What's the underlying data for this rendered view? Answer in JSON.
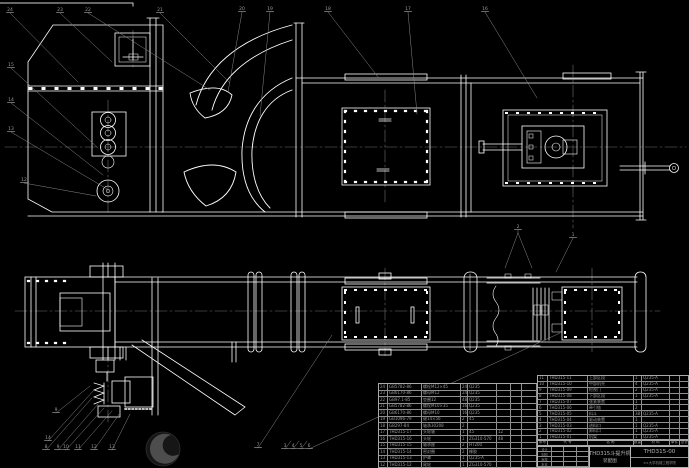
{
  "colors": {
    "background": "#000000",
    "line": "#ffffff",
    "leader": "#8a8a8a",
    "centerline": "#6f6f6f",
    "table_line": "#9b9b9b",
    "table_text": "#9a9a9a"
  },
  "title_block": {
    "product_name": "THD315斗提升机",
    "sheet_name": "装配图",
    "drawing_no": "THD315-00",
    "org": "××大学机械工程学院",
    "sig_labels": [
      "设计",
      "制图",
      "审核",
      "批准"
    ]
  },
  "bom": {
    "header": [
      "序号",
      "代  号",
      "名  称",
      "数量",
      "材  料",
      "单件",
      "总计",
      "备注"
    ],
    "right_rows": [
      [
        "11",
        "THD315-11",
        "上部区段",
        "1",
        "Q235-A",
        "",
        "",
        ""
      ],
      [
        "10",
        "THD315-10",
        "中部机壳",
        "4",
        "Q235-A",
        "",
        "",
        ""
      ],
      [
        "9",
        "THD315-09",
        "检视门",
        "2",
        "Q235-A",
        "",
        "",
        ""
      ],
      [
        "8",
        "THD315-08",
        "下部区段",
        "1",
        "Q235-A",
        "",
        "",
        ""
      ],
      [
        "7",
        "THD315-07",
        "张紧装置",
        "1",
        "",
        "",
        "",
        "螺旋式"
      ],
      [
        "6",
        "THD315-06",
        "牵引链",
        "2",
        "",
        "",
        "",
        ""
      ],
      [
        "5",
        "THD315-05",
        "料斗",
        "38",
        "Q235-A",
        "",
        "",
        ""
      ],
      [
        "4",
        "THD315-04",
        "驱动装置",
        "1",
        "",
        "",
        "",
        "Y132M-4"
      ],
      [
        "3",
        "THD315-03",
        "进料口",
        "1",
        "Q235-A",
        "",
        "",
        ""
      ],
      [
        "2",
        "THD315-02",
        "卸料口",
        "1",
        "Q235-A",
        "",
        "",
        ""
      ],
      [
        "1",
        "THD315-01",
        "机架",
        "1",
        "Q235-A",
        "",
        "",
        ""
      ]
    ],
    "left_rows": [
      [
        "24",
        "GB5782-86",
        "螺栓M12×45",
        "24",
        "Q235",
        "",
        "",
        ""
      ],
      [
        "23",
        "GB6170-86",
        "螺母M12",
        "24",
        "Q235",
        "",
        "",
        ""
      ],
      [
        "22",
        "GB97.1-85",
        "垫圈12",
        "48",
        "Q235",
        "",
        "",
        ""
      ],
      [
        "21",
        "GB5782-86",
        "螺栓M10×35",
        "16",
        "Q235",
        "",
        "",
        ""
      ],
      [
        "20",
        "GB6170-86",
        "螺母M10",
        "16",
        "Q235",
        "",
        "",
        ""
      ],
      [
        "19",
        "GB1096-79",
        "键14×56",
        "2",
        "45",
        "",
        "",
        ""
      ],
      [
        "18",
        "GB297-84",
        "轴承30208",
        "2",
        "",
        "",
        "",
        ""
      ],
      [
        "17",
        "THD315-17",
        "头轮轴",
        "1",
        "45",
        "12",
        "",
        ""
      ],
      [
        "16",
        "THD315-16",
        "头轮",
        "1",
        "ZG310-570",
        "48",
        "",
        ""
      ],
      [
        "15",
        "THD315-15",
        "轴承座",
        "2",
        "HT200",
        "",
        "",
        ""
      ],
      [
        "14",
        "THD315-14",
        "密封圈",
        "2",
        "橡胶",
        "",
        "",
        ""
      ],
      [
        "13",
        "THD315-13",
        "护罩",
        "1",
        "Q235-A",
        "",
        "",
        ""
      ],
      [
        "12",
        "THD315-12",
        "尾轮",
        "1",
        "ZG310-570",
        "",
        "",
        ""
      ]
    ]
  },
  "balloons": [
    {
      "label": "24",
      "x": 10,
      "y": 11,
      "lx": 78,
      "ly": 82
    },
    {
      "label": "23",
      "x": 60,
      "y": 11,
      "lx": 112,
      "ly": 62
    },
    {
      "label": "22",
      "x": 88,
      "y": 11,
      "lx": 210,
      "ly": 90
    },
    {
      "label": "21",
      "x": 160,
      "y": 11,
      "lx": 230,
      "ly": 83
    },
    {
      "label": "20",
      "x": 242,
      "y": 10,
      "lx": 228,
      "ly": 92
    },
    {
      "label": "19",
      "x": 270,
      "y": 10,
      "lx": 260,
      "ly": 116
    },
    {
      "label": "18",
      "x": 328,
      "y": 10,
      "lx": 378,
      "ly": 77
    },
    {
      "label": "17",
      "x": 408,
      "y": 10,
      "lx": 417,
      "ly": 114
    },
    {
      "label": "16",
      "x": 485,
      "y": 10,
      "lx": 537,
      "ly": 98
    },
    {
      "label": "15",
      "x": 11,
      "y": 66,
      "lx": 98,
      "ly": 148
    },
    {
      "label": "14",
      "x": 11,
      "y": 101,
      "lx": 103,
      "ly": 175
    },
    {
      "label": "13",
      "x": 11,
      "y": 130,
      "lx": 107,
      "ly": 189
    },
    {
      "label": "12",
      "x": 24,
      "y": 181,
      "lx": 96,
      "ly": 196
    },
    {
      "label": "1",
      "x": 573,
      "y": 236,
      "lx": 556,
      "ly": 272
    },
    {
      "label": "2",
      "x": 518,
      "y": 228,
      "lx": 518,
      "ly": 233
    },
    {
      "label": "3",
      "x": 285,
      "y": 447,
      "lx": 291,
      "ly": 441
    },
    {
      "label": "4",
      "x": 293,
      "y": 447,
      "lx": 299,
      "ly": 441
    },
    {
      "label": "5",
      "x": 301,
      "y": 447,
      "lx": 307,
      "ly": 441
    },
    {
      "label": "6",
      "x": 309,
      "y": 447,
      "lx": 560,
      "ly": 333
    },
    {
      "label": "7",
      "x": 258,
      "y": 446,
      "lx": 332,
      "ly": 335
    },
    {
      "label": "8",
      "x": 46,
      "y": 448,
      "lx": 92,
      "ly": 398
    },
    {
      "label": "9",
      "x": 58,
      "y": 448,
      "lx": 98,
      "ly": 404
    },
    {
      "label": "10",
      "x": 66,
      "y": 448,
      "lx": 104,
      "ly": 408
    },
    {
      "label": "11",
      "x": 78,
      "y": 448,
      "lx": 112,
      "ly": 411
    },
    {
      "label": "12",
      "x": 94,
      "y": 448,
      "lx": 120,
      "ly": 413
    },
    {
      "label": "13",
      "x": 112,
      "y": 448,
      "lx": 130,
      "ly": 414
    },
    {
      "label": "14",
      "x": 48,
      "y": 439,
      "lx": 94,
      "ly": 390
    },
    {
      "label": "9",
      "x": 56,
      "y": 411,
      "lx": 90,
      "ly": 386
    }
  ]
}
